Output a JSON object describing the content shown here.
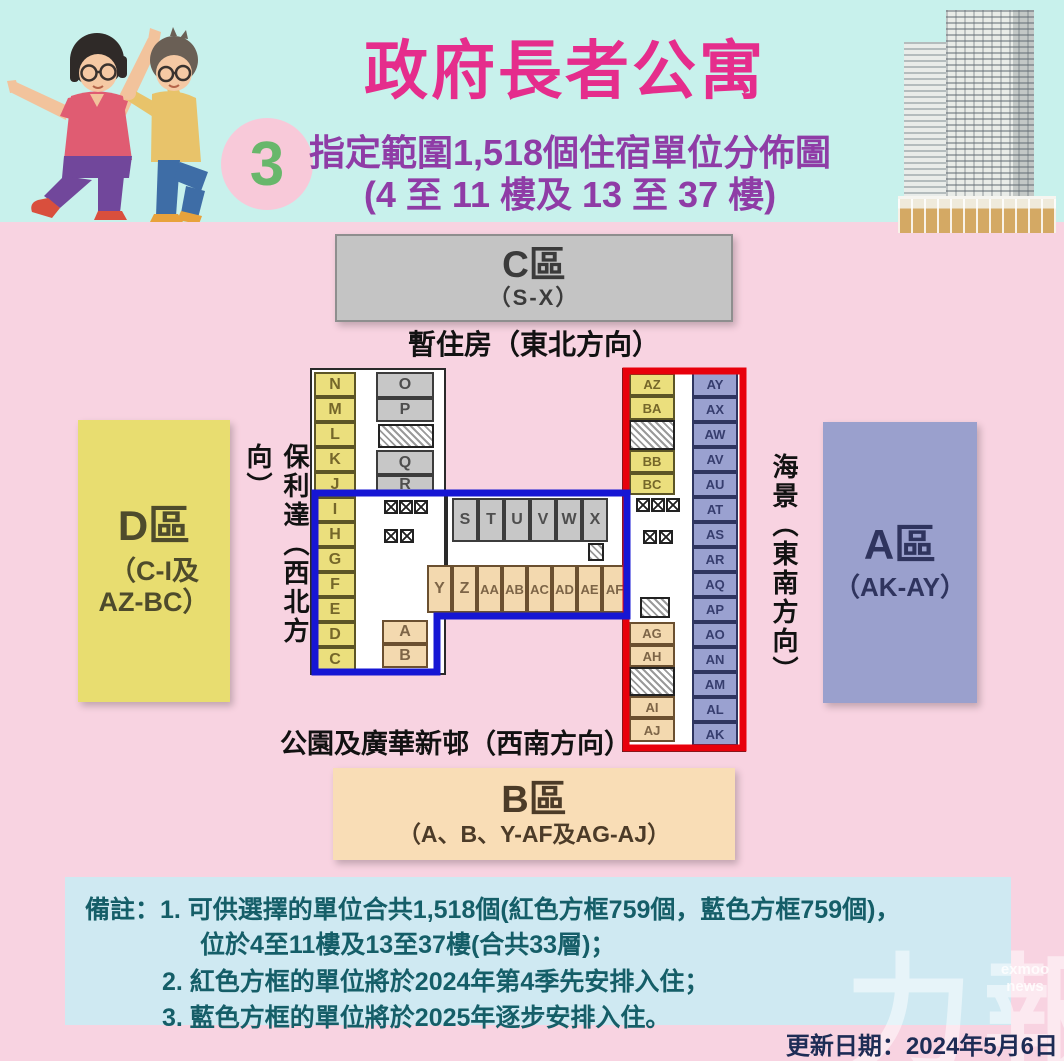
{
  "header": {
    "title": "政府長者公寓",
    "badge": "3",
    "subtitle_line1": "指定範圍1,518個住宿單位分佈圖",
    "subtitle_line2": "(4 至 11 樓及 13 至 37 樓)"
  },
  "zones": {
    "c": {
      "name": "C區",
      "range": "（S-X）"
    },
    "b": {
      "name": "B區",
      "range": "（A、B、Y-AF及AG-AJ）"
    },
    "d": {
      "name": "D區",
      "range_line1": "（C-I及",
      "range_line2": "AZ-BC）"
    },
    "a": {
      "name": "A區",
      "range": "（AK-AY）"
    }
  },
  "directions": {
    "north_east": "暫住房（東北方向）",
    "north_west": "保利達（西北方向）",
    "south_east": "海景（東南方向）",
    "south_west": "公園及廣華新邨（西南方向）"
  },
  "notes": {
    "line1": "備註：1. 可供選擇的單位合共1,518個(紅色方框759個，藍色方框759個)，",
    "line2": "位於4至11樓及13至37樓(合共33層)；",
    "line3": "2. 紅色方框的單位將於2024年第4季先安排入住；",
    "line4": "3. 藍色方框的單位將於2025年逐步安排入住。"
  },
  "footer": {
    "updated": "更新日期：2024年5月6日"
  },
  "watermark": {
    "big": "力報",
    "small": "exmoo news"
  },
  "colors": {
    "header_bg": "#c8f1ec",
    "body_bg": "#f8d3e1",
    "title": "#e52d8c",
    "subtitle": "#8f3ca6",
    "zone_a": "#9aa0cd",
    "zone_b": "#f9ddb6",
    "zone_c": "#c4c4c4",
    "zone_d": "#e8dd70",
    "room_yellow": "#ebdf7d",
    "room_gray": "#c7c7c7",
    "room_beige": "#f3d9af",
    "room_purple": "#9aa1d0",
    "red_outline": "#e8000b",
    "blue_outline": "#1616d4",
    "notes_bg": "#cfe9f2"
  },
  "plan": {
    "room_fields": [
      "label",
      "x",
      "y",
      "w",
      "h",
      "type"
    ],
    "wings": [
      [
        310,
        368,
        136,
        307
      ],
      [
        446,
        490,
        181,
        128
      ],
      [
        622,
        368,
        124,
        384
      ]
    ],
    "rooms": [
      [
        "N",
        314,
        372,
        42,
        25,
        "y"
      ],
      [
        "M",
        314,
        397,
        42,
        25,
        "y"
      ],
      [
        "L",
        314,
        422,
        42,
        25,
        "y"
      ],
      [
        "K",
        314,
        447,
        42,
        25,
        "y"
      ],
      [
        "J",
        314,
        472,
        42,
        25,
        "y"
      ],
      [
        "I",
        314,
        497,
        42,
        25,
        "y"
      ],
      [
        "H",
        314,
        522,
        42,
        25,
        "y"
      ],
      [
        "G",
        314,
        547,
        42,
        25,
        "y"
      ],
      [
        "F",
        314,
        572,
        42,
        25,
        "y"
      ],
      [
        "E",
        314,
        597,
        42,
        25,
        "y"
      ],
      [
        "D",
        314,
        622,
        42,
        25,
        "y"
      ],
      [
        "C",
        314,
        647,
        42,
        25,
        "y"
      ],
      [
        "O",
        376,
        372,
        58,
        26,
        "g"
      ],
      [
        "P",
        376,
        398,
        58,
        24,
        "g"
      ],
      [
        "Q",
        376,
        450,
        58,
        25,
        "g"
      ],
      [
        "R",
        376,
        475,
        58,
        20,
        "g"
      ],
      [
        "S",
        452,
        498,
        26,
        44,
        "g"
      ],
      [
        "T",
        478,
        498,
        26,
        44,
        "g"
      ],
      [
        "U",
        504,
        498,
        26,
        44,
        "g"
      ],
      [
        "V",
        530,
        498,
        26,
        44,
        "g"
      ],
      [
        "W",
        556,
        498,
        26,
        44,
        "g"
      ],
      [
        "X",
        582,
        498,
        26,
        44,
        "g"
      ],
      [
        "Y",
        427,
        565,
        25,
        48,
        "b"
      ],
      [
        "Z",
        452,
        565,
        25,
        48,
        "b"
      ],
      [
        "AA",
        477,
        565,
        25,
        48,
        "b"
      ],
      [
        "AB",
        502,
        565,
        25,
        48,
        "b"
      ],
      [
        "AC",
        527,
        565,
        25,
        48,
        "b"
      ],
      [
        "AD",
        552,
        565,
        25,
        48,
        "b"
      ],
      [
        "AE",
        577,
        565,
        25,
        48,
        "b"
      ],
      [
        "AF",
        602,
        565,
        25,
        48,
        "b"
      ],
      [
        "A",
        382,
        620,
        46,
        24,
        "b"
      ],
      [
        "B",
        382,
        644,
        46,
        24,
        "b"
      ],
      [
        "AZ",
        629,
        373,
        46,
        23,
        "y"
      ],
      [
        "BA",
        629,
        396,
        46,
        24,
        "y"
      ],
      [
        "BB",
        629,
        450,
        46,
        23,
        "y"
      ],
      [
        "BC",
        629,
        473,
        46,
        22,
        "y"
      ],
      [
        "AG",
        629,
        622,
        46,
        23,
        "b"
      ],
      [
        "AH",
        629,
        645,
        46,
        22,
        "b"
      ],
      [
        "AI",
        629,
        696,
        46,
        22,
        "b"
      ],
      [
        "AJ",
        629,
        718,
        46,
        24,
        "b"
      ],
      [
        "AY",
        692,
        372,
        46,
        25,
        "p"
      ],
      [
        "AX",
        692,
        397,
        46,
        25,
        "p"
      ],
      [
        "AW",
        692,
        422,
        46,
        25,
        "p"
      ],
      [
        "AV",
        692,
        447,
        46,
        25,
        "p"
      ],
      [
        "AU",
        692,
        472,
        46,
        25,
        "p"
      ],
      [
        "AT",
        692,
        497,
        46,
        25,
        "p"
      ],
      [
        "AS",
        692,
        522,
        46,
        25,
        "p"
      ],
      [
        "AR",
        692,
        547,
        46,
        25,
        "p"
      ],
      [
        "AQ",
        692,
        572,
        46,
        25,
        "p"
      ],
      [
        "AP",
        692,
        597,
        46,
        25,
        "p"
      ],
      [
        "AO",
        692,
        622,
        46,
        25,
        "p"
      ],
      [
        "AN",
        692,
        647,
        46,
        25,
        "p"
      ],
      [
        "AM",
        692,
        672,
        46,
        25,
        "p"
      ],
      [
        "AL",
        692,
        697,
        46,
        25,
        "p"
      ],
      [
        "AK",
        692,
        722,
        46,
        24,
        "p"
      ]
    ],
    "elevator_boxes": [
      [
        384,
        500
      ],
      [
        399,
        500
      ],
      [
        414,
        500
      ],
      [
        384,
        529
      ],
      [
        400,
        529
      ],
      [
        636,
        498
      ],
      [
        651,
        498
      ],
      [
        666,
        498
      ],
      [
        643,
        530
      ],
      [
        659,
        530
      ]
    ],
    "hatch_blocks": [
      [
        378,
        424,
        56,
        24
      ],
      [
        629,
        420,
        46,
        30
      ],
      [
        629,
        667,
        46,
        29
      ],
      [
        640,
        597,
        30,
        21
      ],
      [
        588,
        543,
        16,
        18
      ]
    ],
    "outline_blue_points": "315,493 627,493 627,616 437,616 437,672 315,672",
    "outline_red": {
      "x": 626,
      "y": 371,
      "w": 117,
      "h": 377
    }
  }
}
